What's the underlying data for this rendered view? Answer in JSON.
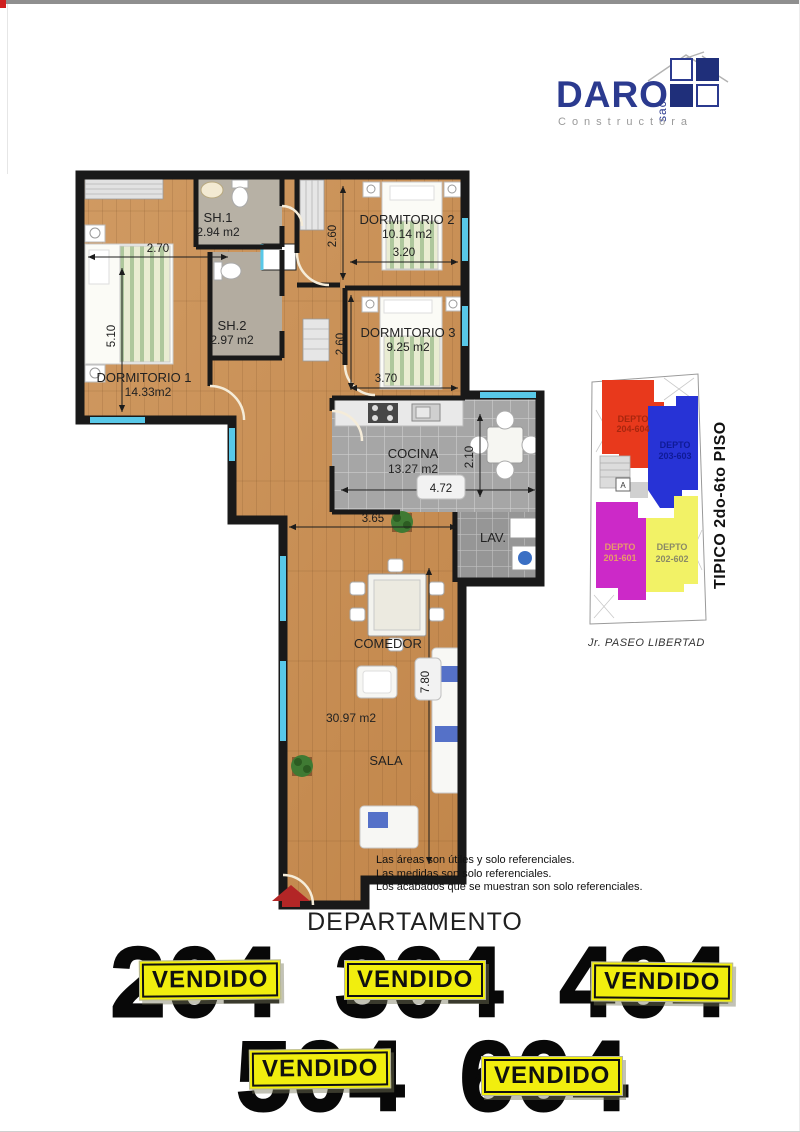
{
  "logo": {
    "name": "DARO",
    "suffix": "sac",
    "tagline": "Constructora",
    "brand_color": "#2b3a8f"
  },
  "plan": {
    "rooms": {
      "dormitorio1": {
        "label": "DORMITORIO 1",
        "area": "14.33m2"
      },
      "dormitorio2": {
        "label": "DORMITORIO 2",
        "area": "10.14 m2"
      },
      "dormitorio3": {
        "label": "DORMITORIO 3",
        "area": "9.25 m2"
      },
      "sh1": {
        "label": "SH.1",
        "area": "2.94 m2"
      },
      "sh2": {
        "label": "SH.2",
        "area": "2.97 m2"
      },
      "cocina": {
        "label": "COCINA",
        "area": "13.27 m2"
      },
      "lavanderia": {
        "label": "LAV."
      },
      "comedor": {
        "label": "COMEDOR"
      },
      "sala": {
        "label": "SALA",
        "area": "30.97 m2"
      }
    },
    "dimensions": {
      "dorm1_width": "2.70",
      "dorm1_depth": "5.10",
      "dorm2_depth": "2.60",
      "dorm2_width": "3.20",
      "dorm3_depth": "2.60",
      "dorm3_width": "3.70",
      "cocina_depth": "2.10",
      "cocina_width": "4.72",
      "comedor_width": "3.65",
      "sala_depth": "7.80"
    },
    "wall_color": "#191919",
    "window_color": "#58c8e8"
  },
  "key_plan": {
    "caption_vertical": "TIPICO 2do-6to PISO",
    "street": "Jr. PASEO LIBERTAD",
    "elevator": "A",
    "units": [
      {
        "line1": "DEPTO",
        "line2": "204-604",
        "color": "#e8391c",
        "text_color": "#a8260e"
      },
      {
        "line1": "DEPTO",
        "line2": "203-603",
        "color": "#2733d6",
        "text_color": "#0f1a96"
      },
      {
        "line1": "DEPTO",
        "line2": "201-601",
        "color": "#cc29c8",
        "text_color": "#e89a6a"
      },
      {
        "line1": "DEPTO",
        "line2": "202-602",
        "color": "#f2f266",
        "text_color": "#8a8a66"
      }
    ]
  },
  "disclaimer": {
    "line1": "Las áreas son útiles y solo referenciales.",
    "line2": "Las medidas son solo referenciales.",
    "line3": "Los acabados que se muestran son solo referenciales."
  },
  "listing": {
    "title": "DEPARTAMENTO",
    "sold_label": "VENDIDO",
    "sold_bg": "#f1ee0e",
    "row1": [
      {
        "number": "204"
      },
      {
        "number": "304"
      },
      {
        "number": "404"
      }
    ],
    "row2": [
      {
        "number": "504"
      },
      {
        "number": "604"
      }
    ]
  }
}
